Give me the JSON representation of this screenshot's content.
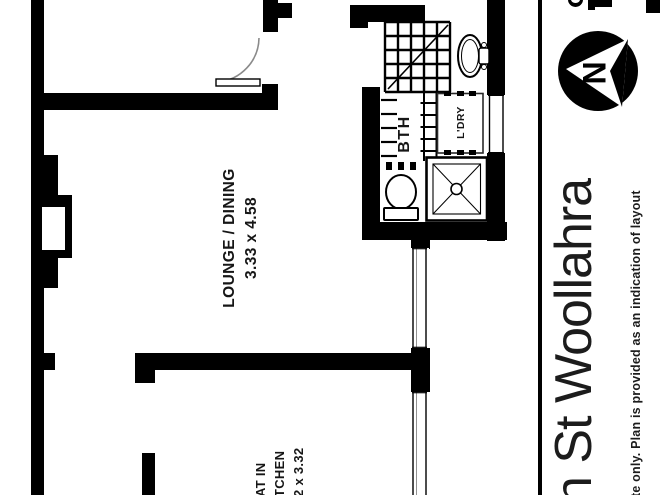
{
  "plan": {
    "rooms": {
      "lounge_dining": {
        "label": "LOUNGE / DINING",
        "dimensions": "3.33 x 4.58"
      },
      "bathroom": {
        "label": "BTH"
      },
      "laundry": {
        "label": "L'DRY"
      },
      "kitchen": {
        "label_line1": "AT IN",
        "label_line2": "TCHEN",
        "dimensions": "2 x 3.32"
      }
    }
  },
  "sidebar": {
    "address": "n St Woollahra",
    "disclaimer": "te only. Plan is provided as an indication of layout",
    "compass": {
      "label": "N"
    }
  },
  "colors": {
    "wall": "#000000",
    "door_arc": "#8a8a8a",
    "text": "#161616"
  }
}
